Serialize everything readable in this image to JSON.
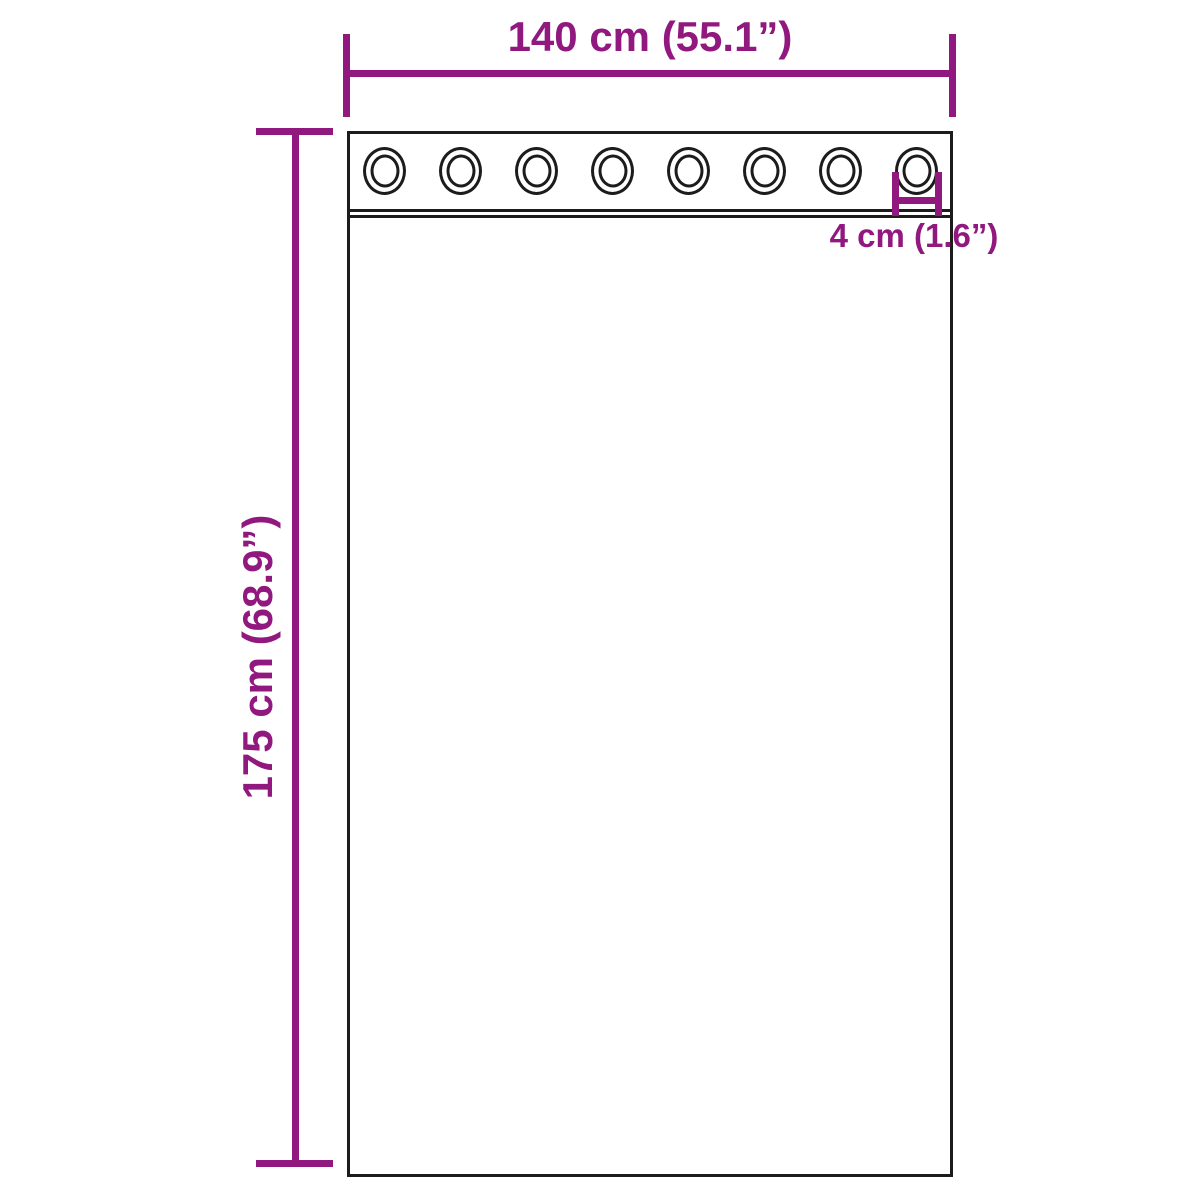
{
  "diagram": {
    "type": "curtain-dimension-diagram",
    "colors": {
      "dimension_annotation": "#91187f",
      "outline": "#1c1c1c",
      "background": "#ffffff"
    },
    "curtain": {
      "grommet_count": 8
    },
    "annotations": {
      "width_label": "140 cm (55.1”)",
      "height_label": "175 cm (68.9”)",
      "grommet_label": "4 cm (1.6”)"
    }
  }
}
